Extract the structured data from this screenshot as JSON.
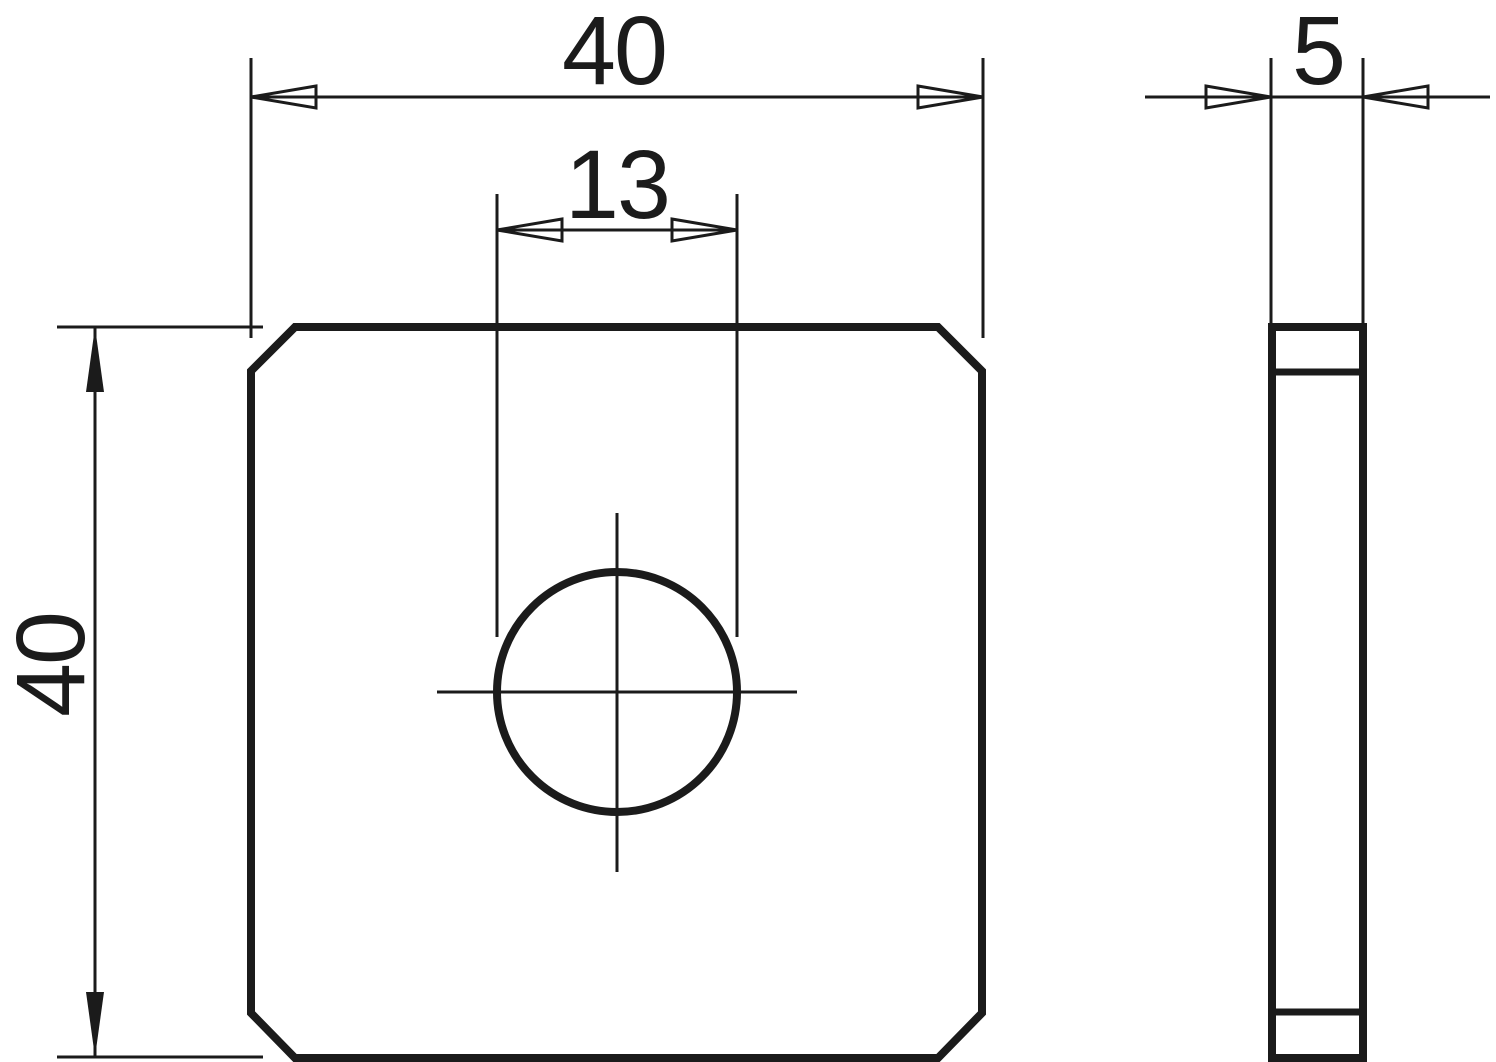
{
  "drawing": {
    "kind": "technical-drawing-two-views",
    "part": "square-plate-with-center-hole",
    "colors": {
      "line": "#1b1b1b",
      "background": "#ffffff"
    },
    "front_view": {
      "width_dim": "40",
      "height_dim": "40",
      "hole_dim": "13"
    },
    "side_view": {
      "thickness_dim": "5"
    }
  }
}
